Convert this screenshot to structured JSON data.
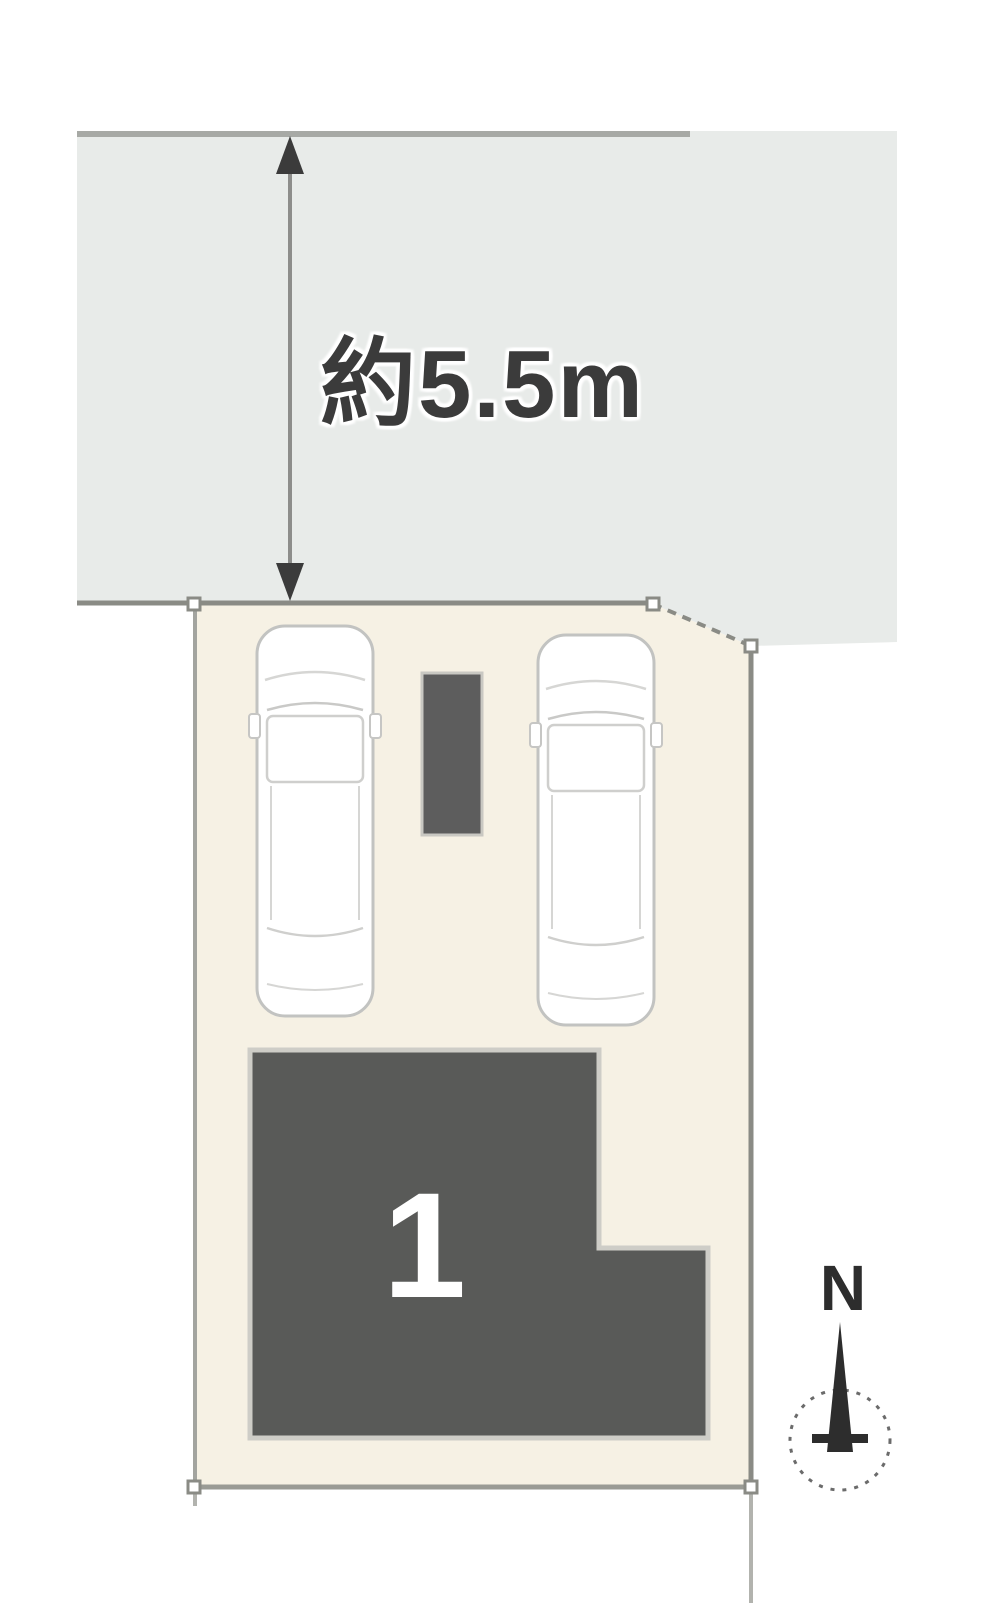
{
  "annotations": {
    "road_width_label": "約5.5m"
  },
  "building": {
    "number": "1"
  },
  "compass": {
    "north_label": "N"
  },
  "colors": {
    "road": "#e8ebe9",
    "road_edge": "#a7a9a5",
    "plot": "#f6f1e4",
    "boundary": "#8a8b85",
    "boundary_light": "#b2b3ae",
    "building": "#595a58",
    "block": "#5d5d5d",
    "car_outline": "#c2c3c1",
    "car_detail": "#d6d6d4",
    "ink": "#3b3b3b",
    "compass_ink": "#2d2d2d"
  }
}
